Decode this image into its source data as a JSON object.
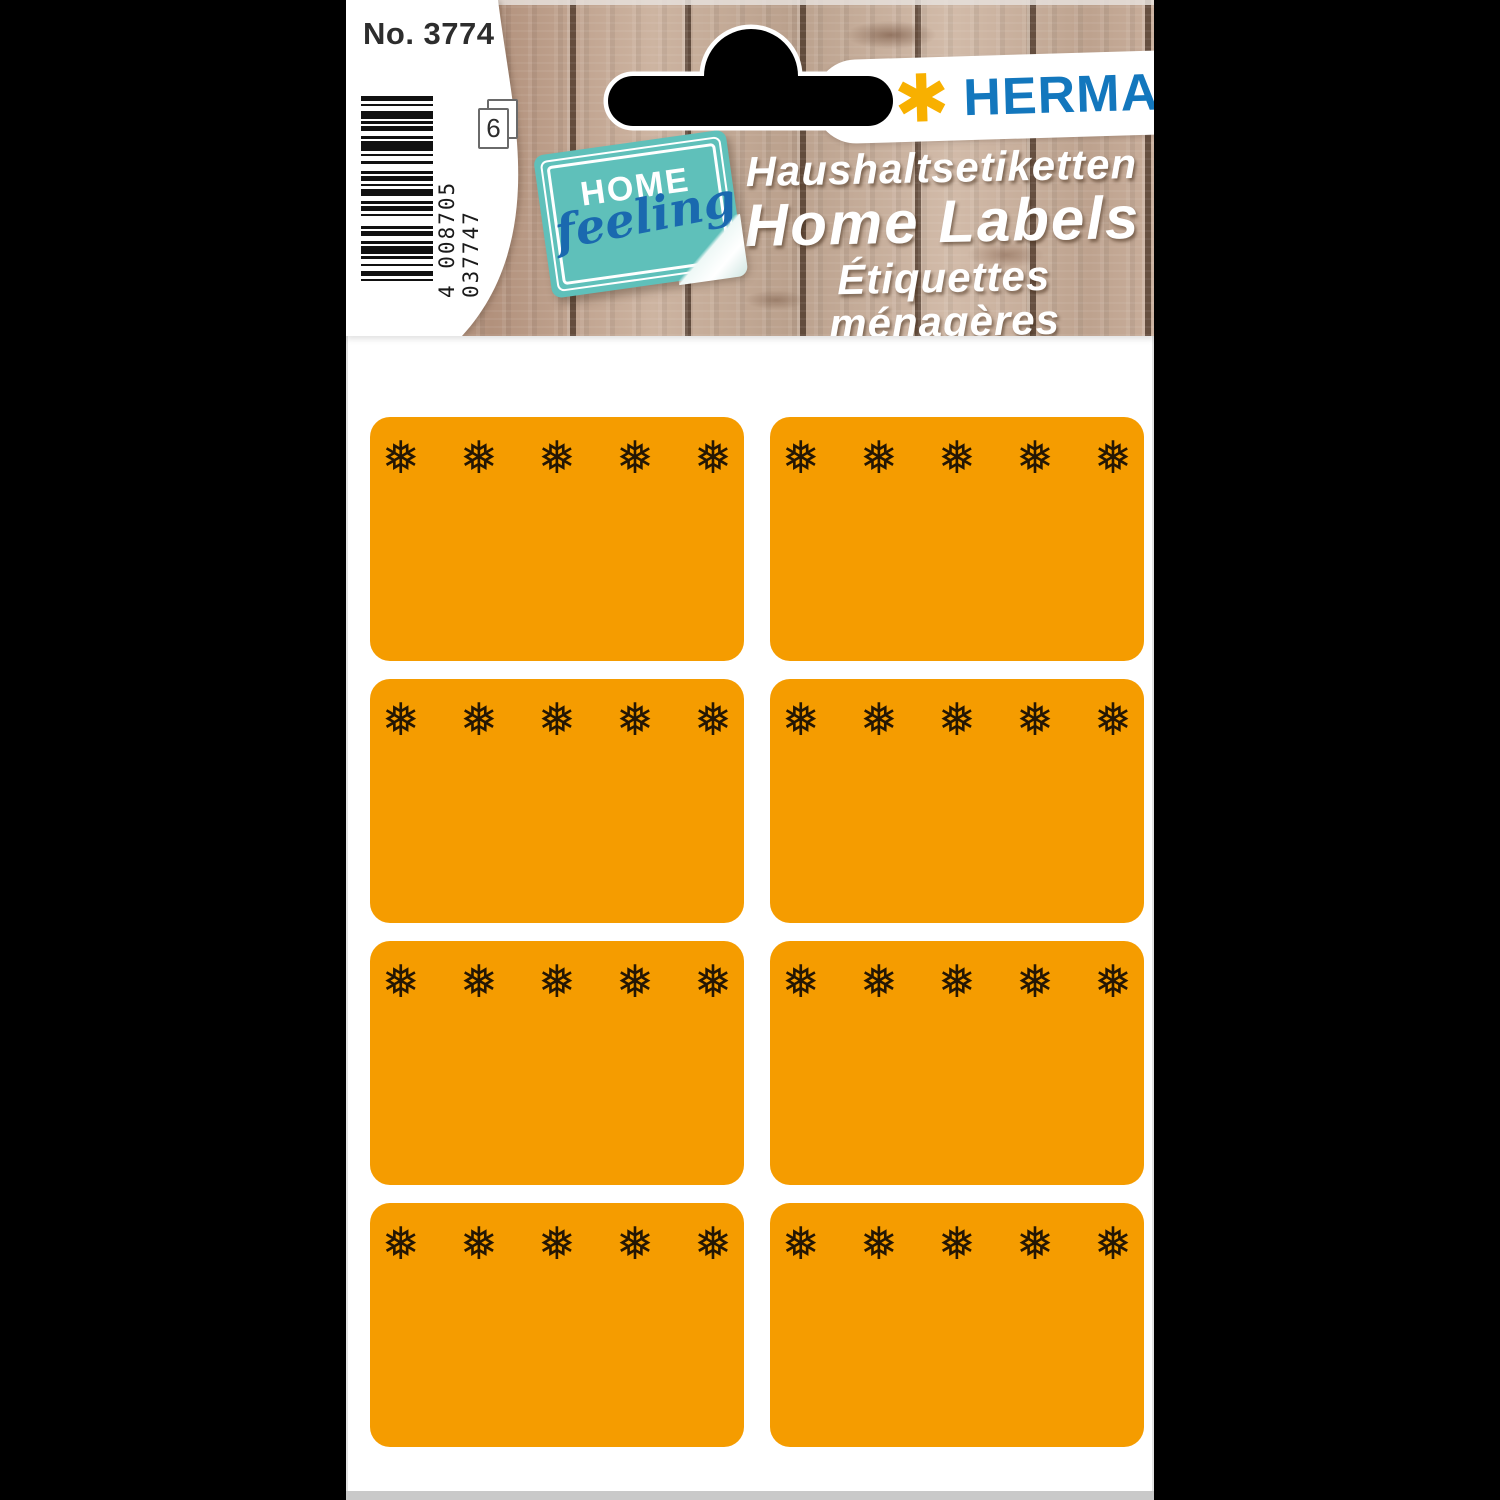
{
  "product": {
    "article_number": "No. 3774",
    "barcode_number": "4 008705 037747",
    "sheet_count": "6",
    "brand_name": "HERMA",
    "brand_mark": "✱",
    "badge_home": "HOME",
    "badge_feeling": "feeling",
    "title_de": "Haushaltsetiketten",
    "title_en": "Home Labels",
    "title_fr": "Étiquettes ménagères"
  },
  "labels_sheet": {
    "rows": 4,
    "columns": 2,
    "snowflakes_per_label": 5,
    "snowflake_glyph": "❅",
    "label_color": "#f59c00",
    "snowflake_color": "#241603"
  },
  "colors": {
    "background": "#000000",
    "card": "#ffffff",
    "herma_blue": "#1377bd",
    "asterisk_yellow": "#f8b000",
    "sticker_teal": "#5fc0ba",
    "feeling_blue": "#1a69af",
    "wood_dark_gap": "#38231 6"
  }
}
